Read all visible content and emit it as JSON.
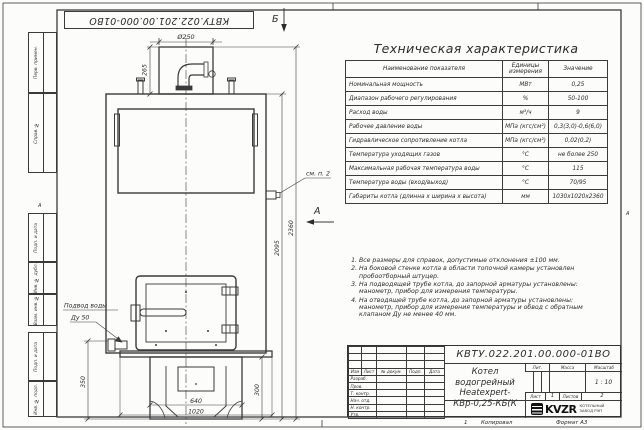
{
  "frame": {
    "doc_number_top": "КВТУ.022.201.00.000-01ВО",
    "zone_letter_left": "А",
    "zone_letter_right": "А",
    "margin_stamps": [
      "Перв. примен.",
      "Справ. №",
      "Подп. и дата",
      "Инв. № дубл.",
      "Взам. инв. №",
      "Подп. и дата",
      "Инв. № подл."
    ],
    "footer": {
      "zone_number": "1",
      "copied_label": "Копировал",
      "format_label": "Формат А3"
    }
  },
  "drawing": {
    "view_b_label": "Б",
    "view_a_label": "А",
    "see_note_label": "см. п. 2",
    "water_inlet_line1": "Подвод воды",
    "water_inlet_line2": "Ду 50",
    "dimensions": {
      "chimney_diameter": "Ø250",
      "chimney_height": "265",
      "body_height": "2095",
      "total_height": "2360",
      "base_width": "640",
      "total_width": "1020",
      "base_height_left": "350",
      "base_height_right": "300"
    }
  },
  "spec_table": {
    "title": "Техническая характеристика",
    "headers": [
      "Наименование показателя",
      "Единицы измерения",
      "Значение"
    ],
    "rows": [
      [
        "Номинальная мощность",
        "МВт",
        "0,25"
      ],
      [
        "Диапазон рабочего регулирования",
        "%",
        "50-100"
      ],
      [
        "Расход воды",
        "м³/ч",
        "9"
      ],
      [
        "Рабочее давление воды",
        "МПа (кгс/см²)",
        "0,3(3,0)-0,6(6,0)"
      ],
      [
        "Гидравлическое сопротивление котла",
        "МПа (кгс/см²)",
        "0,02(0,2)"
      ],
      [
        "Температура уходящих газов",
        "°С",
        "не более 250"
      ],
      [
        "Максимальная рабочая температура воды",
        "°С",
        "115"
      ],
      [
        "Температура воды (вход/выход)",
        "°С",
        "70/95"
      ],
      [
        "Габариты котла (длинна х ширина х высота)",
        "мм",
        "1030х1020х2360"
      ]
    ]
  },
  "notes": [
    "Все размеры для справок, допустимые отклонения ±100 мм.",
    "На боковой стенке котла в области топочной камеры установлен пробоотборный штуцер.",
    "На подводящей трубе котла, до запорной арматуры установлены: манометр, прибор для измерения температуры.",
    "На отводящей трубе котла, до запорной арматуры установлены: манометр, прибор для измерения температуры и обвод с обратным клапаном Ду не менее 40 мм."
  ],
  "title_block": {
    "doc_number": "КВТУ.022.201.00.000-01ВО",
    "product_name_line1": "Котел водогрейный",
    "product_name_line2": "Heatexpert-КВр-0,25-КБ(К",
    "rev_header": [
      "Изм",
      "Лист",
      "№ докум.",
      "Подп.",
      "Дата"
    ],
    "sign_labels": [
      "Разраб.",
      "Пров.",
      "Т. контр.",
      "Нач. отд.",
      "Н. контр.",
      "Утв."
    ],
    "lit_label": "Лит.",
    "mass_label": "Масса",
    "scale_label": "Масштаб",
    "scale_value": "1 : 10",
    "sheet_label": "Лист",
    "sheet_number": "1",
    "sheets_label": "Листов",
    "sheets_total": "2",
    "company": {
      "logo_text": "KVZR",
      "sub_line1": "КОТЕЛЬНЫЙ",
      "sub_line2": "ЗАВОД РЭП"
    }
  }
}
